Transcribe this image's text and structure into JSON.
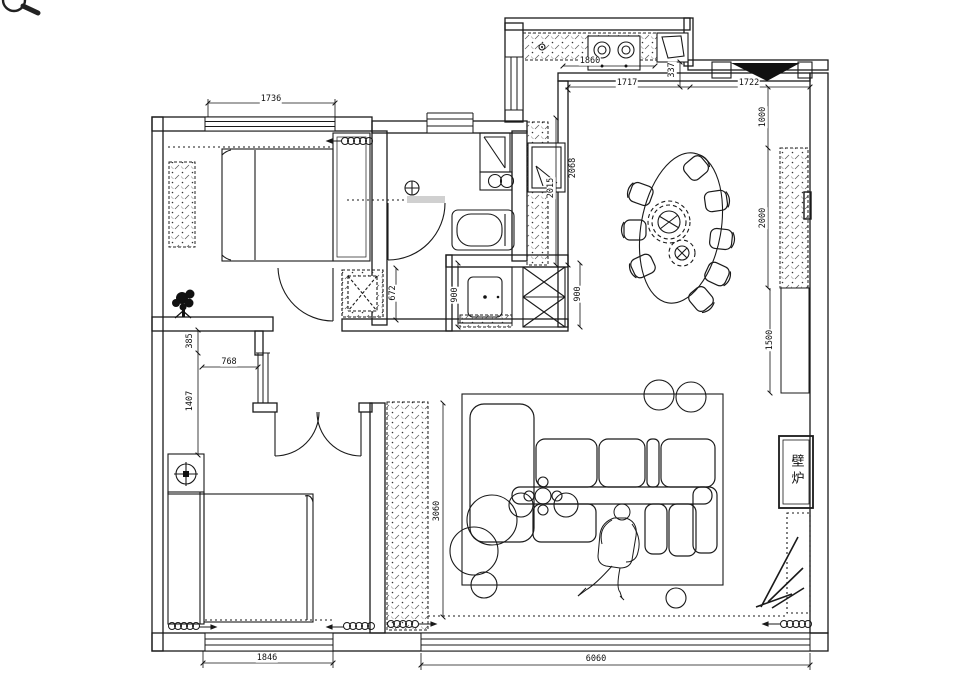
{
  "tool": {
    "magnifier_icon": "magnifier"
  },
  "plan": {
    "fireplace_label": "壁炉",
    "dims": {
      "bd1_window": "1736",
      "kitchen_counter": "1860",
      "kitchen_offset": "337",
      "dining_top_left": "1717",
      "dining_top_right": "1722",
      "right_seg1": "1000",
      "right_seg2": "2000",
      "right_seg3": "1500",
      "kitchen_depth_outer": "2068",
      "kitchen_depth_inner": "2015",
      "laundry_width": "900",
      "flue_width": "900",
      "shower_depth": "672",
      "hall_seg1": "385",
      "hall_opening": "768",
      "hall_seg2": "1407",
      "living_cabinet_run": "3060",
      "bd2_window": "1846",
      "living_window": "6060"
    }
  }
}
